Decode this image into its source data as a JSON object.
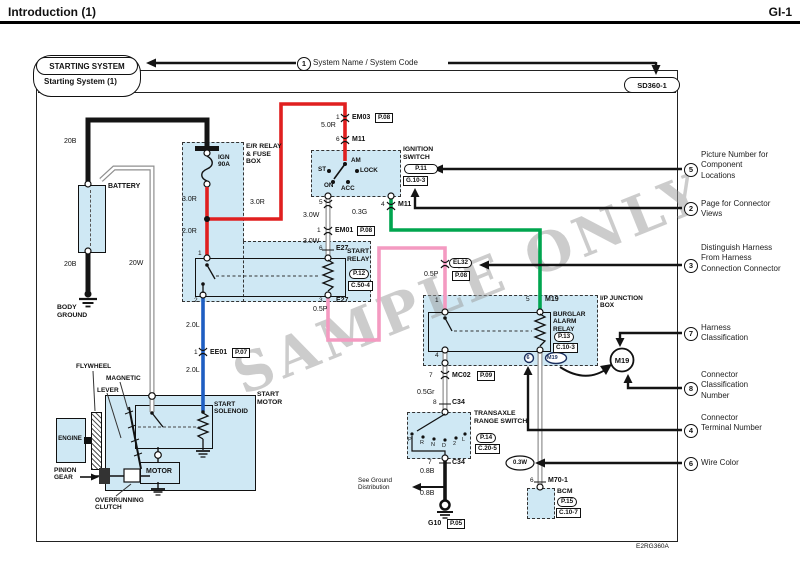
{
  "header": {
    "title": "Introduction (1)",
    "page": "GI-1"
  },
  "title_block": {
    "system_name": "STARTING SYSTEM",
    "system_subtitle": "Starting System (1)",
    "system_code": "SD360-1"
  },
  "callouts": {
    "c1": {
      "num": "1",
      "text": "System Name / System Code"
    },
    "c5": {
      "num": "5",
      "text": "Picture Number for Component Locations"
    },
    "c2": {
      "num": "2",
      "text": "Page for Connector Views"
    },
    "c3": {
      "num": "3",
      "text": "Distinguish Harness From Harness Connection Connector"
    },
    "c7": {
      "num": "7",
      "text": "Harness Classification"
    },
    "c8": {
      "num": "8",
      "text": "Connector Classification Number"
    },
    "c4": {
      "num": "4",
      "text": "Connector Terminal Number"
    },
    "c6": {
      "num": "6",
      "text": "Wire Color"
    }
  },
  "components": {
    "battery": "BATTERY",
    "body_ground": "BODY GROUND",
    "er_box": "E/R RELAY & FUSE BOX",
    "fuse": "IGN 90A",
    "ignition_switch": "IGNITION SWITCH",
    "start_relay": "START RELAY",
    "ip_box": "I/P JUNCTION BOX",
    "burglar_relay": "BURGLAR ALARM RELAY",
    "transaxle_switch": "TRANSAXLE RANGE SWITCH",
    "bcm": "BCM",
    "start_motor": "START MOTOR",
    "start_solenoid": "START SOLENOID",
    "motor": "MOTOR",
    "engine": "ENGINE",
    "flywheel": "FLYWHEEL",
    "magnetic": "MAGNETIC",
    "lever": "LEVER",
    "pinion_gear": "PINION GEAR",
    "overrunning_clutch": "OVERRUNNING CLUTCH",
    "see_ground": "See Ground Distribution"
  },
  "ign_positions": {
    "am": "AM",
    "st": "ST",
    "lock": "LOCK",
    "on": "ON",
    "acc": "ACC"
  },
  "gear_positions": {
    "p": "P",
    "r": "R",
    "n": "N",
    "d": "D",
    "two": "2",
    "l": "L"
  },
  "wires": {
    "b20_1": "20B",
    "b20_2": "20B",
    "w20": "20W",
    "r30_1": "3.0R",
    "r20": "2.0R",
    "r30_2": "3.0R",
    "r50": "5.0R",
    "w30_1": "3.0W",
    "w30_2": "3.0W",
    "g03": "0.3G",
    "p05_1": "0.5P",
    "p05_2": "0.5P",
    "gr05": "0.5Gr",
    "b08_1": "0.8B",
    "b08_2": "0.8B",
    "w03": "0.3W",
    "l20_1": "2.0L",
    "l20_2": "2.0L"
  },
  "pins": {
    "em03_pin": "1",
    "em03": "EM03",
    "em03_page": "P.08",
    "m11_pin": "6",
    "m11": "M11",
    "ign5": "5",
    "m11b_pin": "4",
    "m11b": "M11",
    "em01_pin": "1",
    "em01": "EM01",
    "em01_page": "P.08",
    "e27t_pin": "6",
    "e27t": "E27",
    "e27b_pin": "3",
    "e27b": "E27",
    "sr1": "1",
    "sr2": "2",
    "ee01_pin": "1",
    "ee01": "EE01",
    "ee01_page": "P.07",
    "el32": "EL32",
    "el32_page": "P.08",
    "jb1": "1",
    "jb5": "5",
    "jb5_conn": "M19",
    "jb4": "4",
    "mc02_pin": "7",
    "mc02": "MC02",
    "mc02_page": "P.09",
    "c34t_pin": "8",
    "c34t": "C34",
    "c34b_pin": "7",
    "c34b": "C34",
    "g10": "G10",
    "g10_page": "P.05",
    "m19_term": "6",
    "m19_oval": "M19",
    "m19_circle": "M19",
    "m70_pin": "6",
    "m70": "M70-1"
  },
  "refs": {
    "ign_pic": "P.11",
    "ign_conn": "G.10-3",
    "sr_pic": "P.12",
    "sr_conn": "C.50-4",
    "ba_pic": "P.13",
    "ba_conn": "C.10-3",
    "tr_pic": "P.14",
    "tr_conn": "C.20-5",
    "bcm_pic": "P.15",
    "bcm_conn": "C.10-7"
  },
  "watermark": "SAMPLE ONLY",
  "footer": {
    "code": "E2RG360A"
  },
  "colors": {
    "wire_red": "#e01f1f",
    "wire_blue": "#1e5ec2",
    "wire_green": "#00a54f",
    "wire_pink": "#f49ac1",
    "wire_gray": "#8f8f8f",
    "wire_black": "#141414",
    "box_fill": "#cfe8f4",
    "watermark_gray": "#9b9b9b"
  }
}
